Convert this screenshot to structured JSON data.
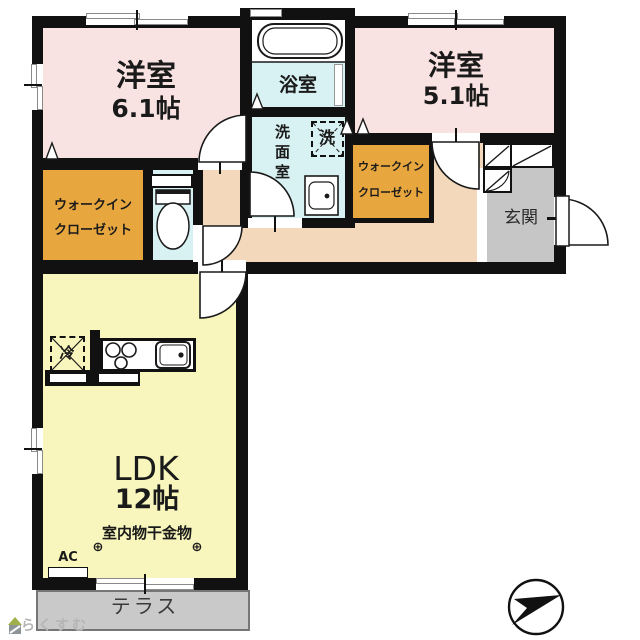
{
  "plan": {
    "bedroom1": {
      "name": "洋室",
      "size": "6.1帖"
    },
    "bedroom2": {
      "name": "洋室",
      "size": "5.1帖"
    },
    "bath": {
      "name": "浴室"
    },
    "washroom": {
      "name": "洗面室"
    },
    "washer": {
      "symbol": "洗"
    },
    "wic_left": {
      "line1": "ウォークイン",
      "line2": "クローゼット"
    },
    "wic_right": {
      "line1": "ウォークイン",
      "line2": "クローゼット"
    },
    "entrance": {
      "name": "玄関"
    },
    "ldk": {
      "name": "LDK",
      "size": "12帖"
    },
    "terrace": {
      "name": "テラス"
    },
    "annotations": {
      "laundry": "室内物干金物",
      "hook_left": "⊕",
      "hook_right": "⊕",
      "ac": "AC",
      "fridge": "冷"
    }
  },
  "watermark": {
    "text": "らくすむ"
  },
  "colors": {
    "bedroom": "#f9e3e2",
    "wet_area": "#d8f1f2",
    "closet": "#e8a63f",
    "hallway": "#f4d8bb",
    "ldk": "#f9f6bd",
    "entrance_floor": "#c6c6c6",
    "terrace": "#c9c9c9",
    "wall": "#111111"
  }
}
